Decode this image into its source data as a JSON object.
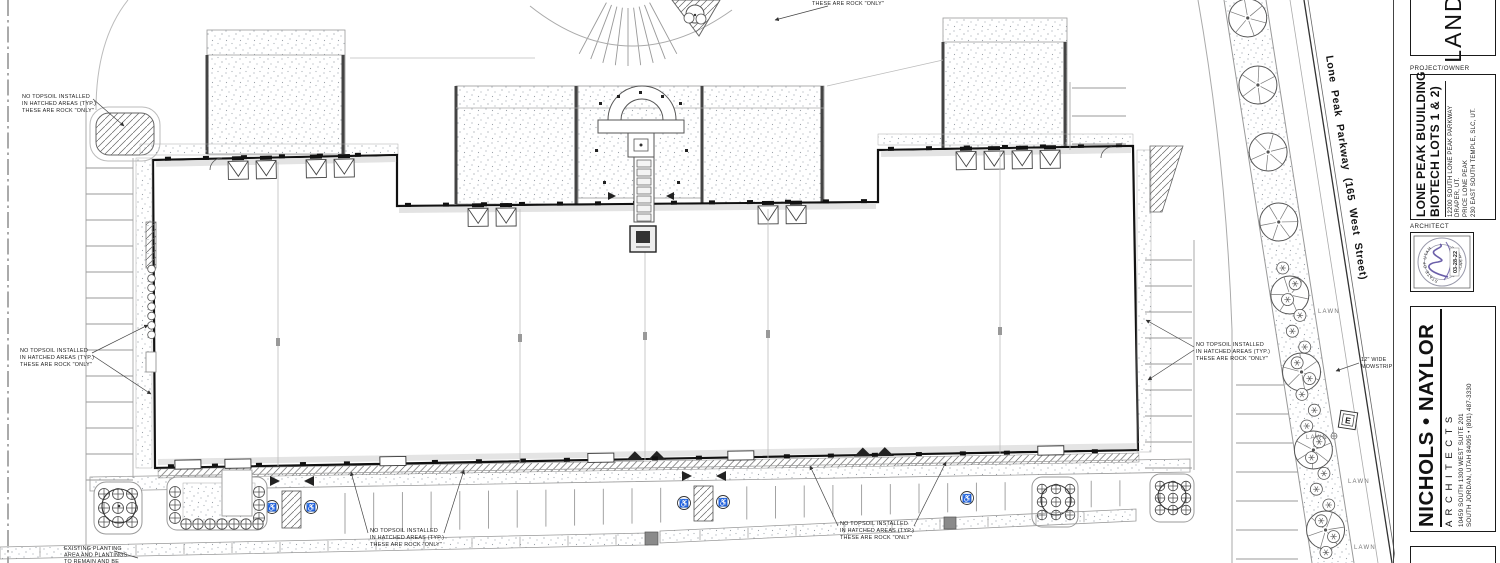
{
  "colors": {
    "line": "#1a1a1a",
    "light_line": "#999999",
    "stipple": "#a7aeb5",
    "hatch": "#666666",
    "signature": "#5b4ea0"
  },
  "notes": {
    "no_topsoil": [
      "NO TOPSOIL INSTALLED",
      "IN HATCHED AREAS (TYP.)",
      "THESE ARE ROCK \"ONLY\""
    ],
    "top_fragment": "THESE ARE ROCK \"ONLY\"",
    "existing_planting": [
      "EXISTING PLANTING",
      "AREA AND PLANTINGS",
      "TO REMAIN AND BE"
    ],
    "mowstrip": [
      "12\" WIDE",
      "MOWSTRIP"
    ]
  },
  "labels": {
    "lawn": "LAWN",
    "e_vault": "E"
  },
  "street": {
    "label": "Lone Peak Parkway (165 West Street)"
  },
  "titleblock": {
    "sheet_title_partial": "LANDS",
    "project_owner_label": "PROJECT/OWNER",
    "project": {
      "title_line1": "LONE PEAK BUUILDING",
      "title_line2": "BIOTECH LOTS 1 & 2)",
      "address1": "12200 SOUTH LONE PEAK PARKWAY",
      "address2": "DRAPER, UT.",
      "address3": "PRICE LONE PEAK",
      "address4": "230 EAST SOUTH TEMPLE, SLC, UT."
    },
    "architect_label": "ARCHITECT",
    "stamp": {
      "date": "03-28-22",
      "seal_top": "STATE OF UTAH",
      "seal_bottom": "LANDSCAPE ARCHITECT"
    },
    "firm": {
      "name": "NICHOLS • NAYLOR",
      "subtitle": "A R C H I T E C T S",
      "address1": "10459  SOUTH  1300  WEST  SUITE  201",
      "address2": "SOUTH JORDAN, UTAH 84095 • (801) 487-3330"
    }
  }
}
